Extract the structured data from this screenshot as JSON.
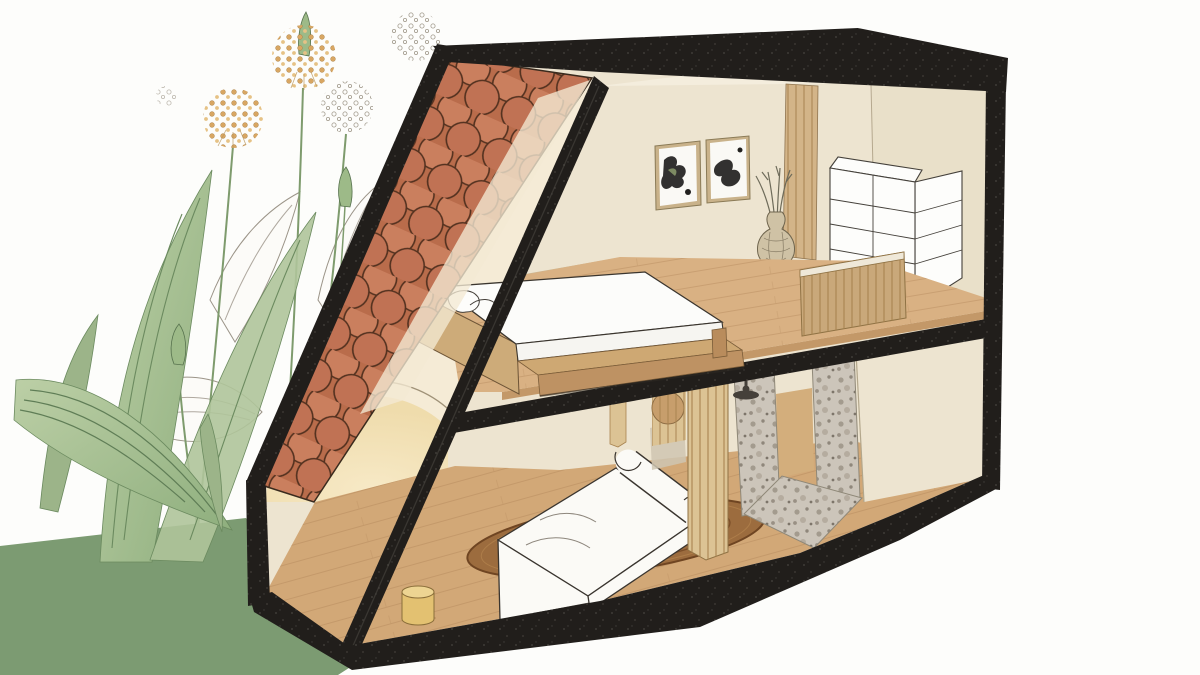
{
  "scene": {
    "kind": "architectural-cutaway-illustration",
    "view": "three-quarter section of a two-storey house interior",
    "objects": [
      "allium-flowers",
      "watercolor-leaves",
      "green-ground",
      "fish-scale-roof-tiles",
      "black-structural-frame",
      "loft-bedroom",
      "bed-with-white-mattress",
      "two-framed-artworks",
      "wall-slat-panel",
      "vase-with-dried-stems",
      "white-bookshelf",
      "mezzanine-slat-railing",
      "living-room",
      "arched-glow",
      "round-jute-rug",
      "white-sofa",
      "yellow-stool",
      "hanging-slat-screen",
      "terrazzo-shower",
      "shower-head",
      "wood-plank-floors"
    ]
  },
  "palette": {
    "background": "#FDFDFB",
    "ground_green": "#7C9B72",
    "leaf_light": "#AFC49A",
    "leaf_mid": "#9CB489",
    "leaf_vein": "#5F7D56",
    "stem_green": "#7E9B6D",
    "bud_green": "#9DBA88",
    "sketch_line": "#9B9488",
    "flower_dot": "#D8A662",
    "flower_dot_light": "#E6C285",
    "flower_sketch_dot": "#A29B8D",
    "frame_black": "#211E1B",
    "tile_base": "#B96C4B",
    "tile_light": "#CA7F5E",
    "tile_mid": "#C07254",
    "tile_fade": "#F3E9D3",
    "wall_cream": "#EDE4D0",
    "wall_right": "#E9E0C9",
    "wall_warm": "#F5EBD6",
    "ceiling": "#F4EDDD",
    "arch_glow": "#F7E9C6",
    "arch_glow_deep": "#EFDCAC",
    "floor_up": "#D9B183",
    "floor_low": "#D2A877",
    "plank_line": "#B58A5D",
    "slab_wood": "#C39868",
    "rug_brown": "#9C6C3E",
    "rug_ring": "#7B4E28",
    "sofa_white": "#FBFAF6",
    "outline_dark": "#3A352F",
    "mattress": "#FCFCFA",
    "stool_top": "#EDD492",
    "stool_side": "#E3C171",
    "bed_head": "#CDAB79",
    "bed_ledge": "#CEA873",
    "bed_front": "#BE9263",
    "slat_wall": "#D3B488",
    "slat_rail": "#C9A87A",
    "slat_hang": "#DCC394",
    "slat_line": "#A8834F",
    "wood_disc": "#C79E6C",
    "terrazzo_base": "#CCC5BA",
    "shower_metal": "#45403A",
    "shelf_white": "#FDFDFB",
    "frame_tan": "#C9B28A",
    "art_ink": "#21201E",
    "art_green": "#8B9B6C",
    "vase_body": "#CFC2A5",
    "panel_gray": "#CFC5B2"
  }
}
